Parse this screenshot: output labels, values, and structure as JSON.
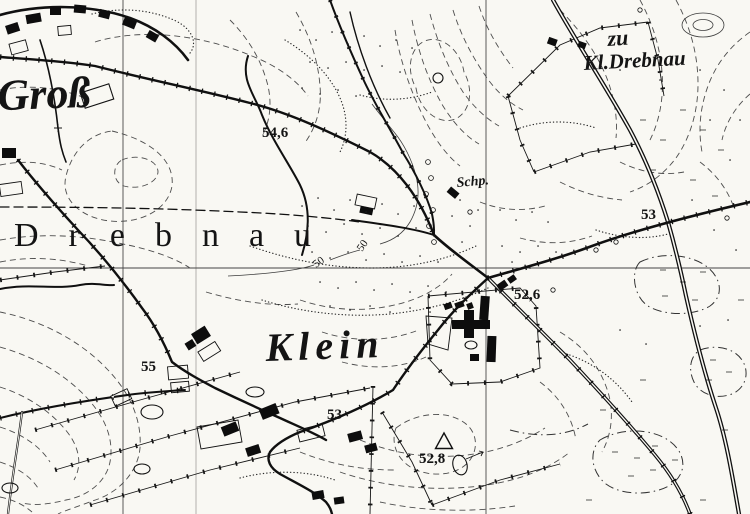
{
  "map": {
    "place_labels": {
      "gross": "Groß",
      "drebnau_spaced": "Drebnau",
      "klein": "Klein",
      "zu": "zu",
      "kl_drebnau": "Kl.Drebnau",
      "schuppen_abbrev": "Schp."
    },
    "elevation_labels": {
      "pt_546": "54,6",
      "pt_55": "55",
      "pt_53_village": "53",
      "pt_53_east": "53",
      "pt_526": "52,6",
      "pt_528": "52,8"
    },
    "contour_labels": {
      "c50_lower": "50",
      "c50_upper": "50"
    },
    "colors": {
      "paper": "#f9f8f3",
      "ink": "#141414",
      "contour": "#4d4d4d",
      "grid": "#5a5a5a"
    }
  }
}
